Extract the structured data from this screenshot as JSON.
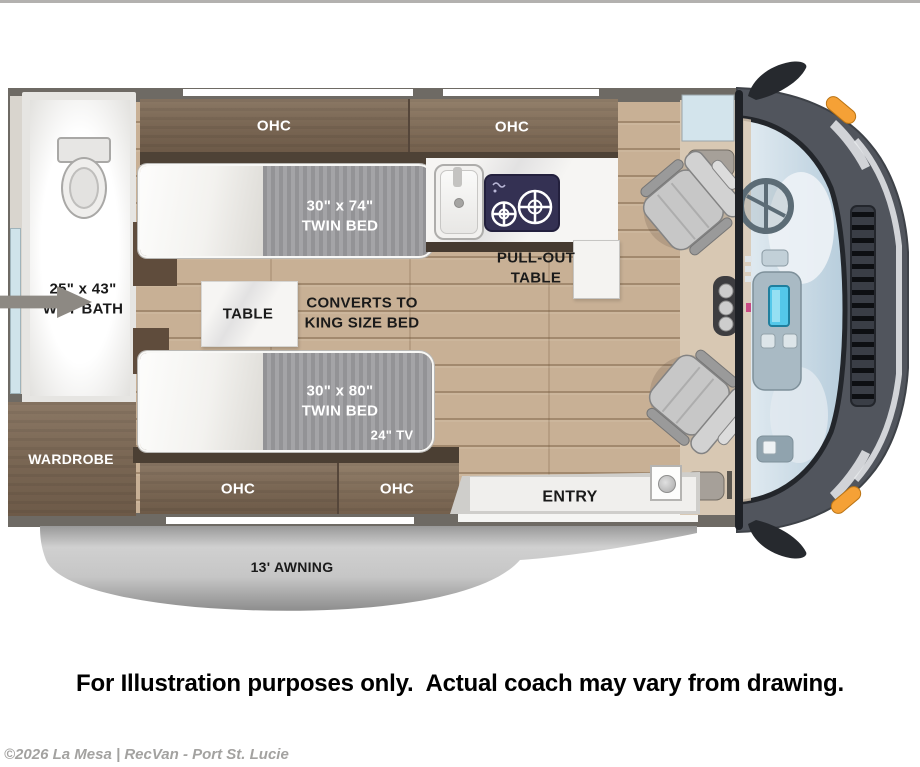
{
  "labels": {
    "ohc": "OHC",
    "twin_bed_74": "30\" x 74\"\nTWIN BED",
    "twin_bed_80": "30\" x 80\"\nTWIN BED",
    "tv": "24\" TV",
    "table": "TABLE",
    "converts": "CONVERTS TO\nKING SIZE BED",
    "wet_bath": "25\" x 43\"\nWET BATH",
    "wardrobe": "WARDROBE",
    "pull_out": "PULL-OUT\nTABLE",
    "entry": "ENTRY",
    "awning": "13' AWNING"
  },
  "footer": {
    "disclaimer": "For Illustration purposes only.  Actual coach may vary from drawing.",
    "copyright": "©2026 La Mesa | RecVan - Port St. Lucie"
  },
  "colors": {
    "floor_wood": "#c8b095",
    "cabinet_wood": "#7b6855",
    "wall_gray": "#6e6a64",
    "mattress_gray": "#9a9a9d",
    "awning_gray": "#c7c7c7",
    "signal_orange": "#f5a136",
    "screen_cyan": "#54c8ea",
    "copyright_gray": "#a3a2a0"
  }
}
